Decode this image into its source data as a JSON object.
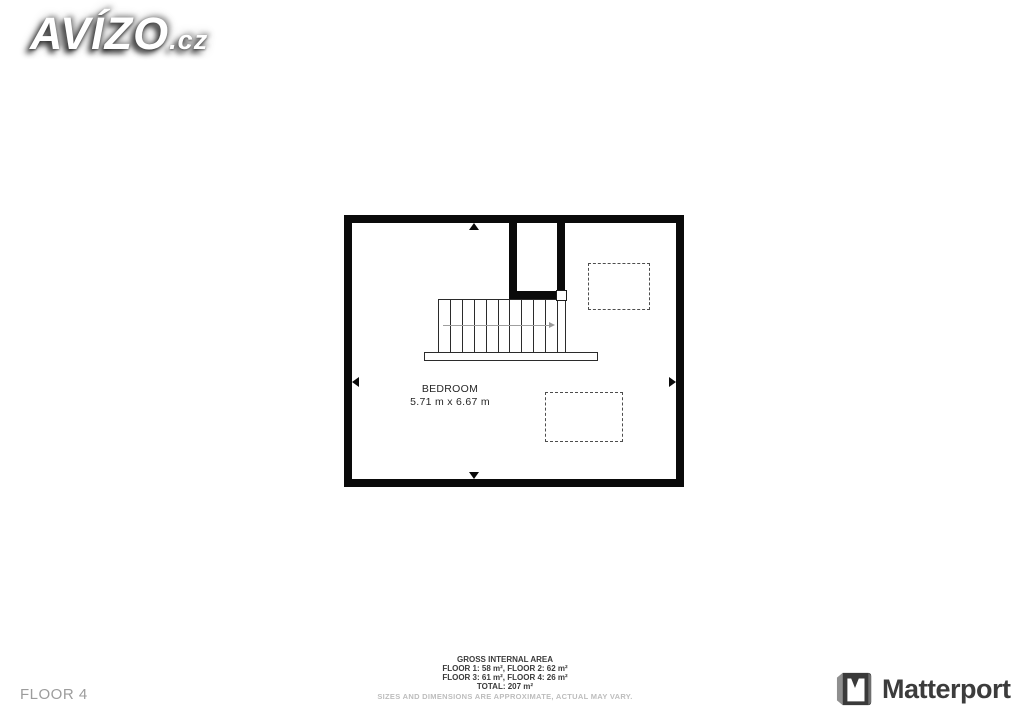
{
  "watermark": {
    "brand": "AVÍZO",
    "suffix": ".cz"
  },
  "floorplan": {
    "room": {
      "name": "BEDROOM",
      "dimensions": "5.71 m x 6.67 m"
    },
    "stairs": {
      "tread_count": 11,
      "direction": "right"
    },
    "skylight_count": 2,
    "colors": {
      "wall": "#0a0a0a",
      "dashed_outline": "#4d4d4d",
      "stair_arrow": "#9f9f9f"
    }
  },
  "footer": {
    "floor_label": "FLOOR 4",
    "area": {
      "title": "GROSS INTERNAL AREA",
      "line1": "FLOOR 1: 58 m², FLOOR 2: 62 m²",
      "line2": "FLOOR 3: 61 m², FLOOR 4: 26 m²",
      "total": "TOTAL: 207 m²",
      "disclaimer": "SIZES AND DIMENSIONS ARE APPROXIMATE, ACTUAL MAY VARY."
    }
  },
  "branding": {
    "matterport": "Matterport"
  },
  "icons": {
    "stair_direction": "arrow-right-icon",
    "wall_markers": [
      "arrow-up-icon",
      "arrow-down-icon",
      "arrow-left-icon",
      "arrow-right-icon"
    ],
    "matterport_mark": "matterport-m-icon"
  }
}
